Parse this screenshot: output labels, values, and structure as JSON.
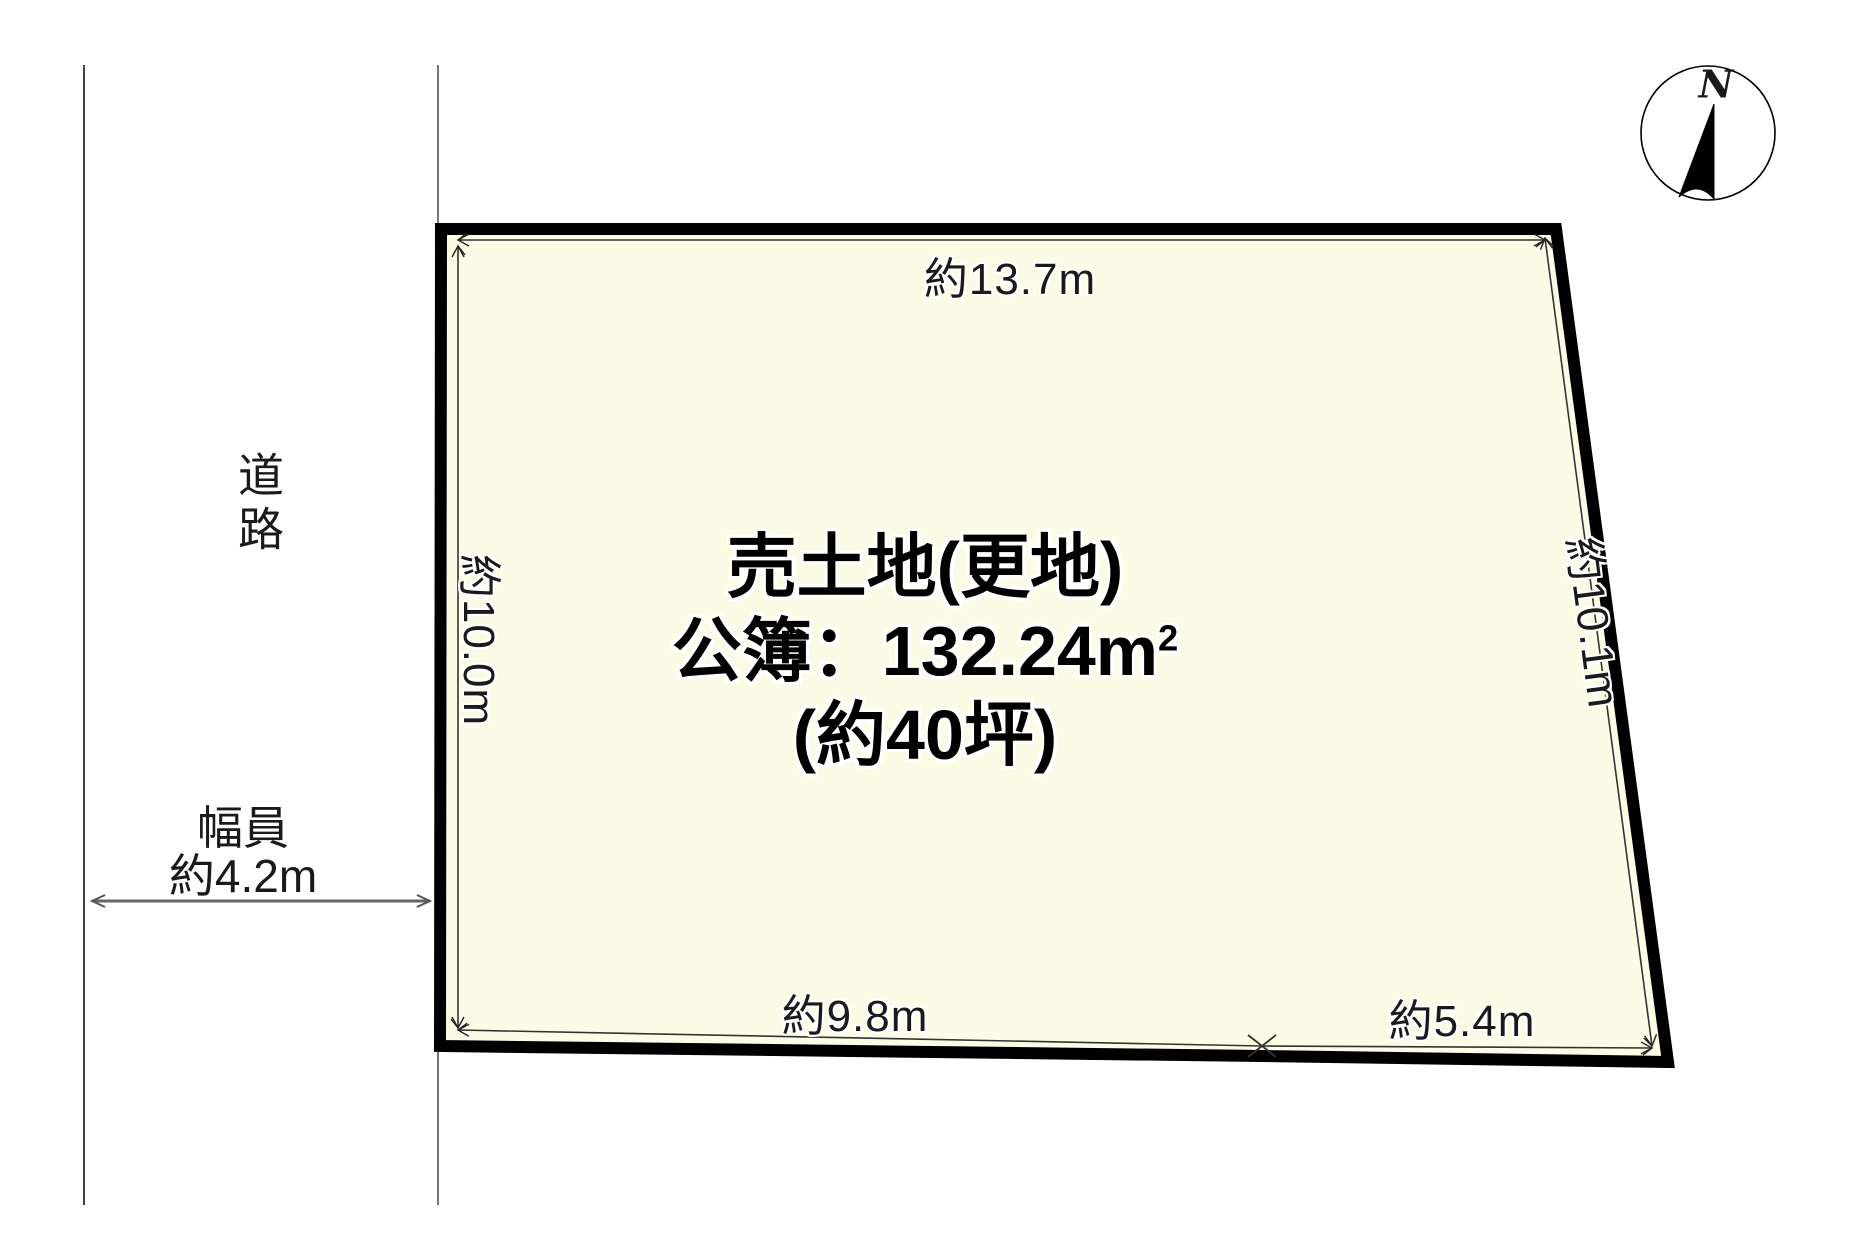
{
  "compass": {
    "north_label": "N"
  },
  "road": {
    "name_label": "道路",
    "width_line1": "幅員",
    "width_line2": "約4.2m"
  },
  "parcel": {
    "fill_color": "#FCFCE6",
    "border_color": "#000000",
    "title_line": "売土地(更地)",
    "area_line_prefix": "公簿：132.24m",
    "area_sup": "2",
    "tsubo_line": "(約40坪)"
  },
  "dimensions": {
    "top": "約13.7m",
    "left": "約10.0m",
    "right": "約10.1m",
    "bottom_left": "約9.8m",
    "bottom_right": "約5.4m"
  }
}
